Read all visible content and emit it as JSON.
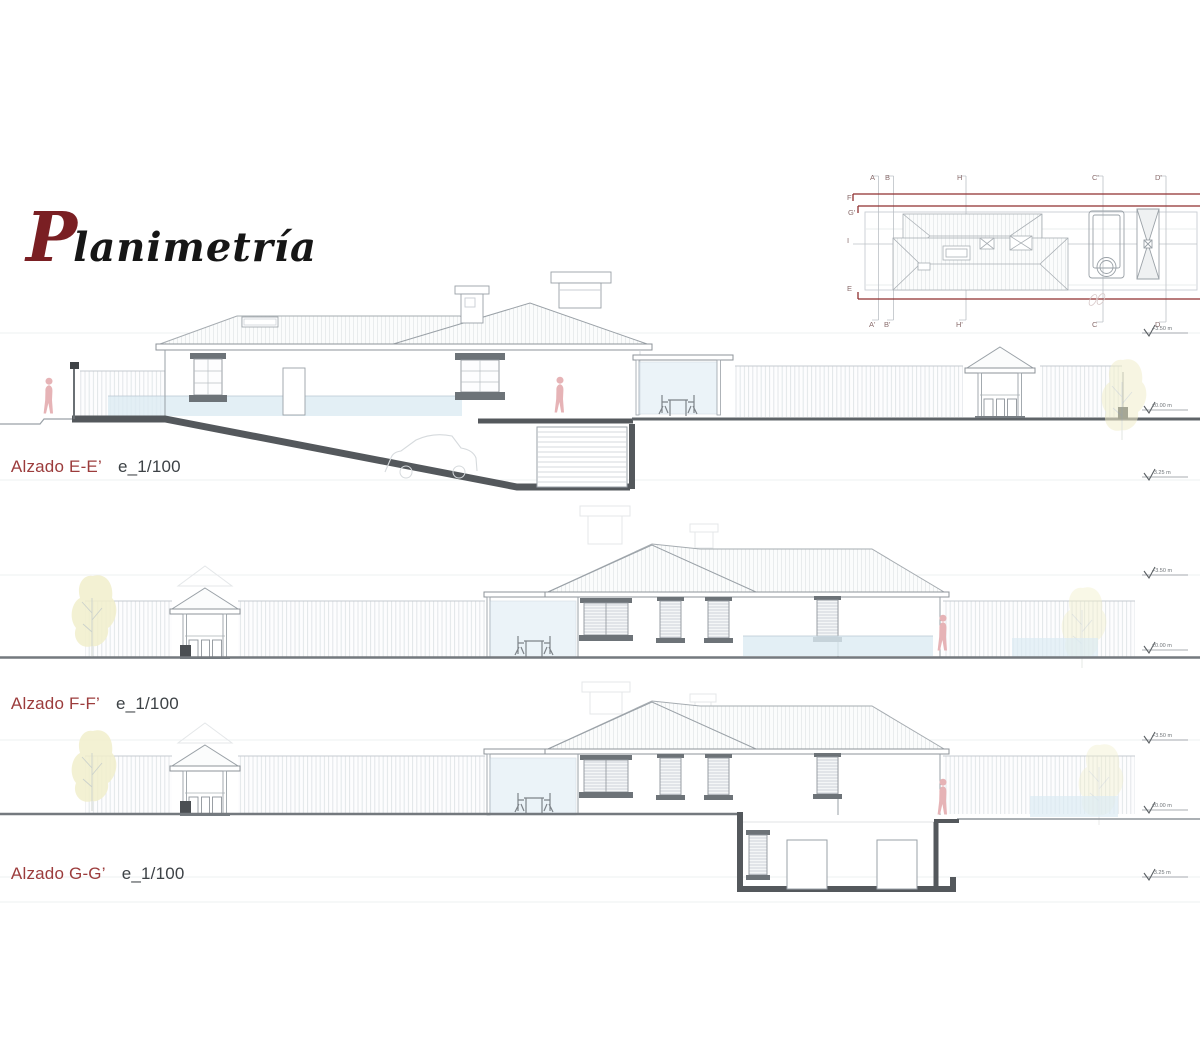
{
  "title": {
    "initial": "P",
    "rest": "lanimetría"
  },
  "roof_plan": {
    "top_labels": [
      "A",
      "B",
      "H",
      "C'",
      "D'"
    ],
    "bottom_labels": [
      "A'",
      "B'",
      "H'",
      "C",
      "D"
    ],
    "left_labels": [
      "F",
      "G'",
      "I",
      "E"
    ]
  },
  "elevations": [
    {
      "name": "Alzado E-E’",
      "scale": "e_1/100",
      "levels": [
        "+3.50 m",
        "±0.00 m",
        "-3.25 m"
      ]
    },
    {
      "name": "Alzado F-F’",
      "scale": "e_1/100",
      "levels": [
        "+3.50 m",
        "±0.00 m"
      ]
    },
    {
      "name": "Alzado G-G’",
      "scale": "e_1/100",
      "levels": [
        "+3.50 m",
        "±0.00 m",
        "-3.25 m"
      ]
    }
  ],
  "colors": {
    "accent_red": "#8f2f2f",
    "label_red": "#9c3c3c",
    "title_red": "#7a1f23",
    "section_dark": "#54585c",
    "line_gray": "#9aa1a7",
    "light_line": "#c9ced3",
    "glass_blue": "#dcebf3",
    "figure_pink": "#e6b3b6",
    "foliage_yellow": "#f1eecb",
    "scale_text": "#3d4246"
  }
}
